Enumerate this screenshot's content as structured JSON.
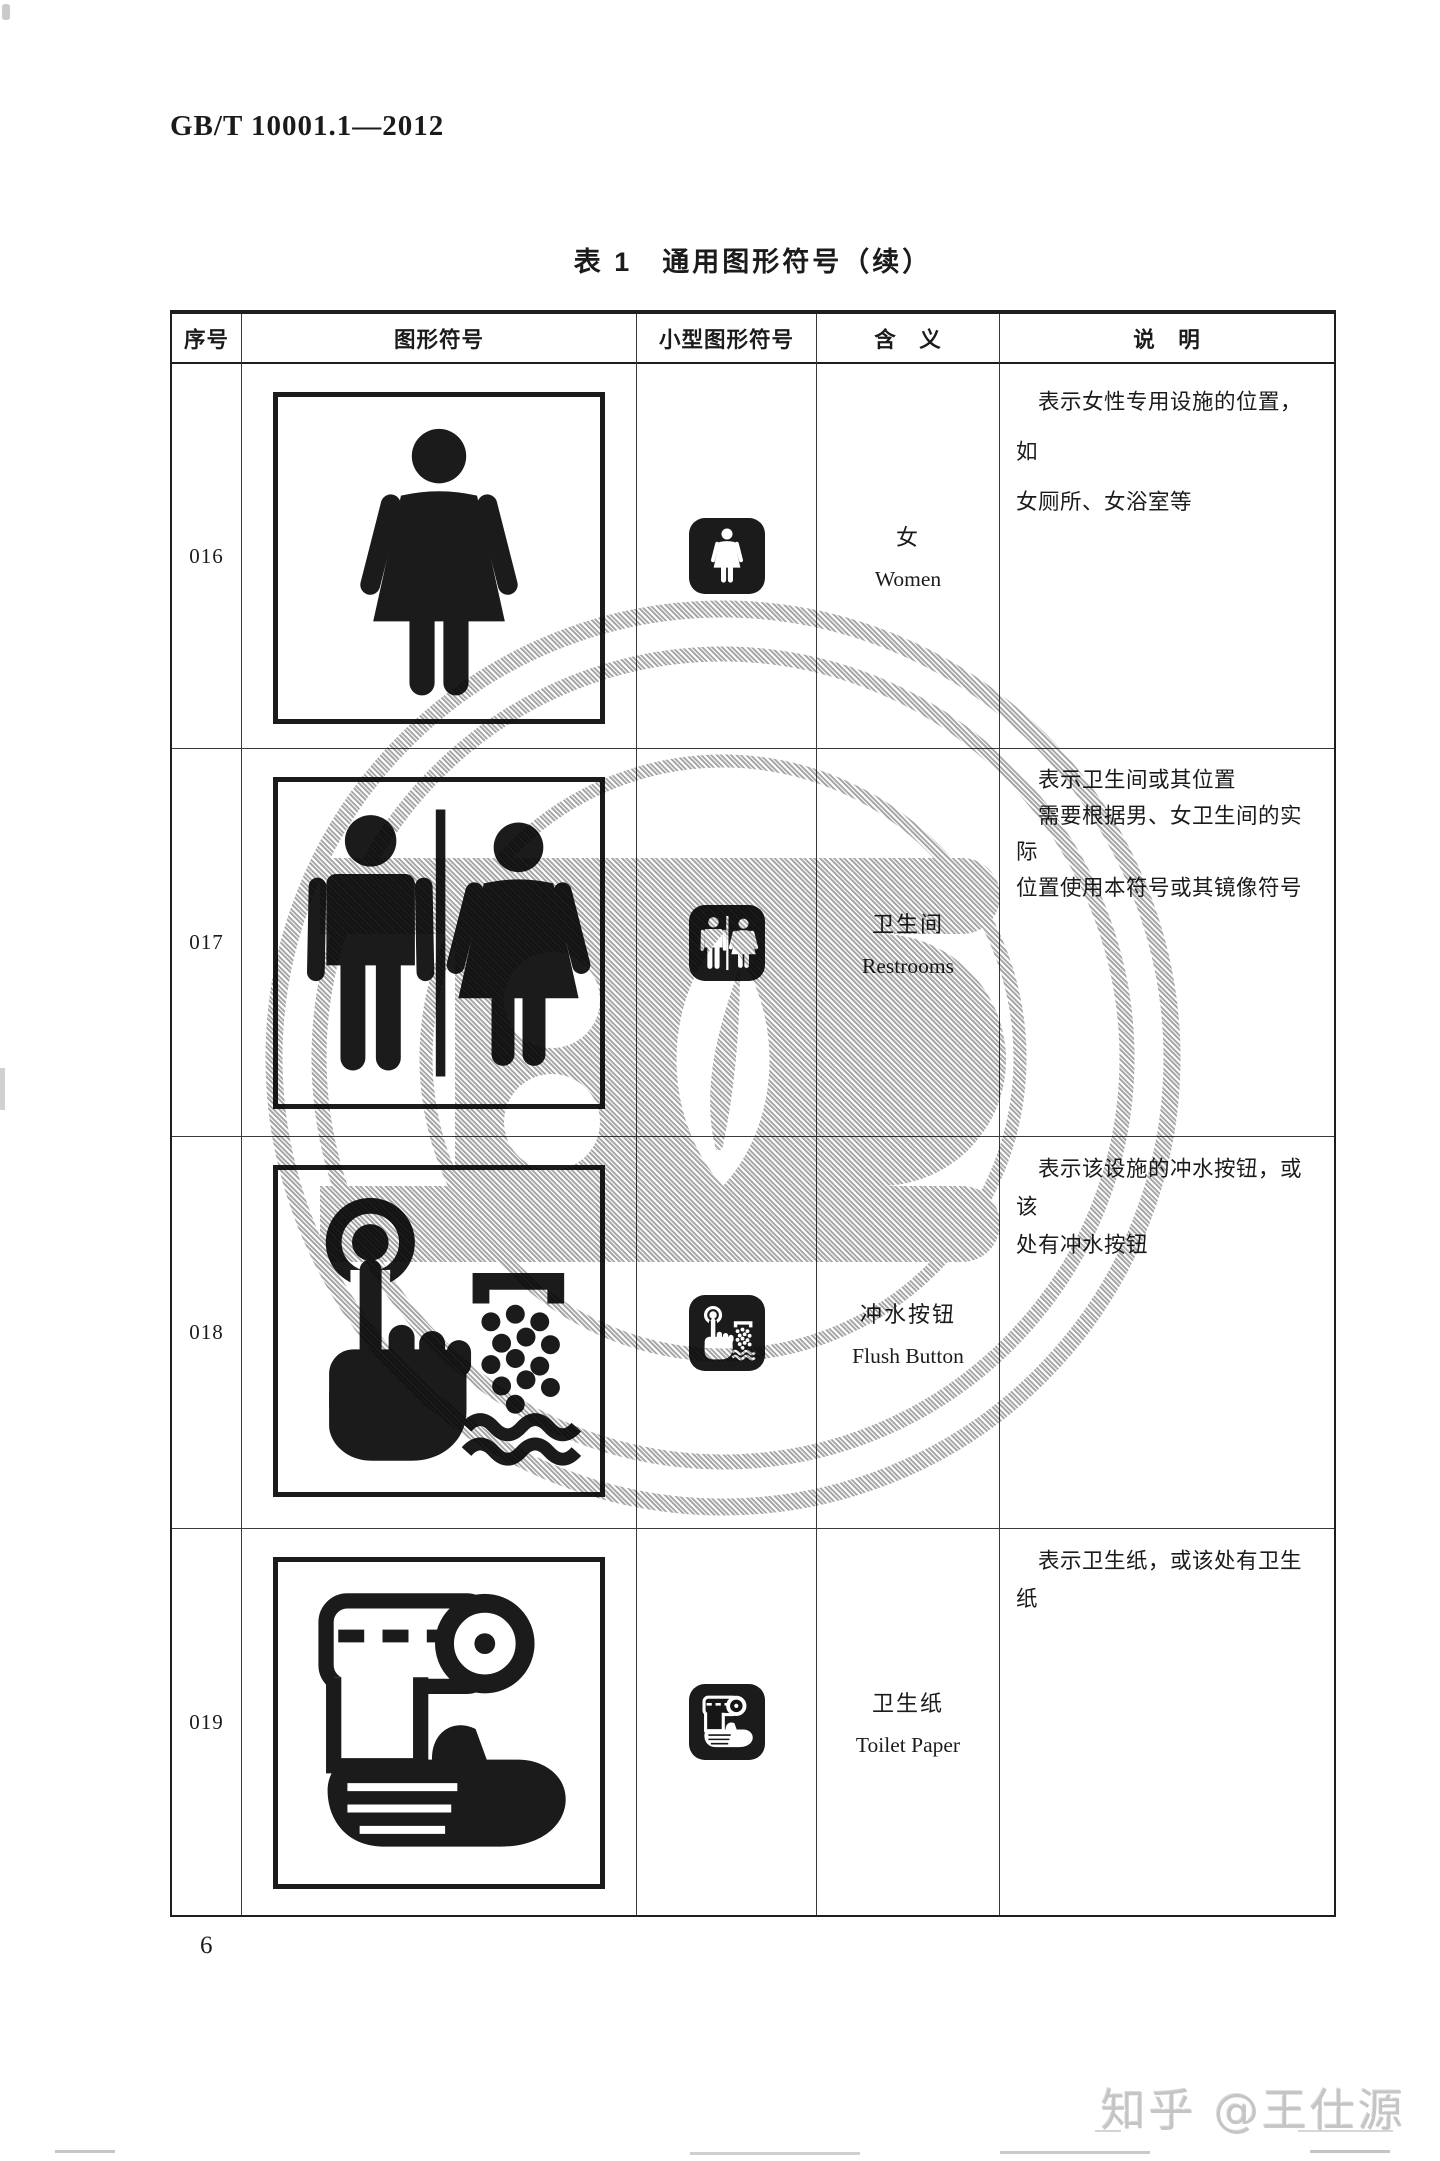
{
  "page": {
    "standard_code": "GB/T 10001.1—2012",
    "page_number": "6",
    "credit_watermark": "知乎 @王仕源"
  },
  "colors": {
    "ink": "#1b1b1b",
    "seal_gray": "#9a9a9a",
    "credit_gray": "#c5c5c5"
  },
  "table": {
    "title": "表 1　通用图形符号（续）",
    "columns": [
      "序号",
      "图形符号",
      "小型图形符号",
      "含　义",
      "说　明"
    ],
    "rows": [
      {
        "no": "016",
        "symbol": "women-pictogram",
        "small_symbol": "women-small-icon",
        "meaning_zh": "女",
        "meaning_en": "Women",
        "description_lines": [
          "　表示女性专用设施的位置，如",
          "女厕所、女浴室等"
        ]
      },
      {
        "no": "017",
        "symbol": "restrooms-pictogram",
        "small_symbol": "restrooms-small-icon",
        "meaning_zh": "卫生间",
        "meaning_en": "Restrooms",
        "description_lines": [
          "　表示卫生间或其位置",
          "　需要根据男、女卫生间的实际",
          "位置使用本符号或其镜像符号"
        ]
      },
      {
        "no": "018",
        "symbol": "flush-button-pictogram",
        "small_symbol": "flush-button-small-icon",
        "meaning_zh": "冲水按钮",
        "meaning_en": "Flush Button",
        "description_lines": [
          "　表示该设施的冲水按钮，或该",
          "处有冲水按钮"
        ]
      },
      {
        "no": "019",
        "symbol": "toilet-paper-pictogram",
        "small_symbol": "toilet-paper-small-icon",
        "meaning_zh": "卫生纸",
        "meaning_en": "Toilet Paper",
        "description_lines": [
          "　表示卫生纸，或该处有卫生纸"
        ]
      }
    ]
  }
}
